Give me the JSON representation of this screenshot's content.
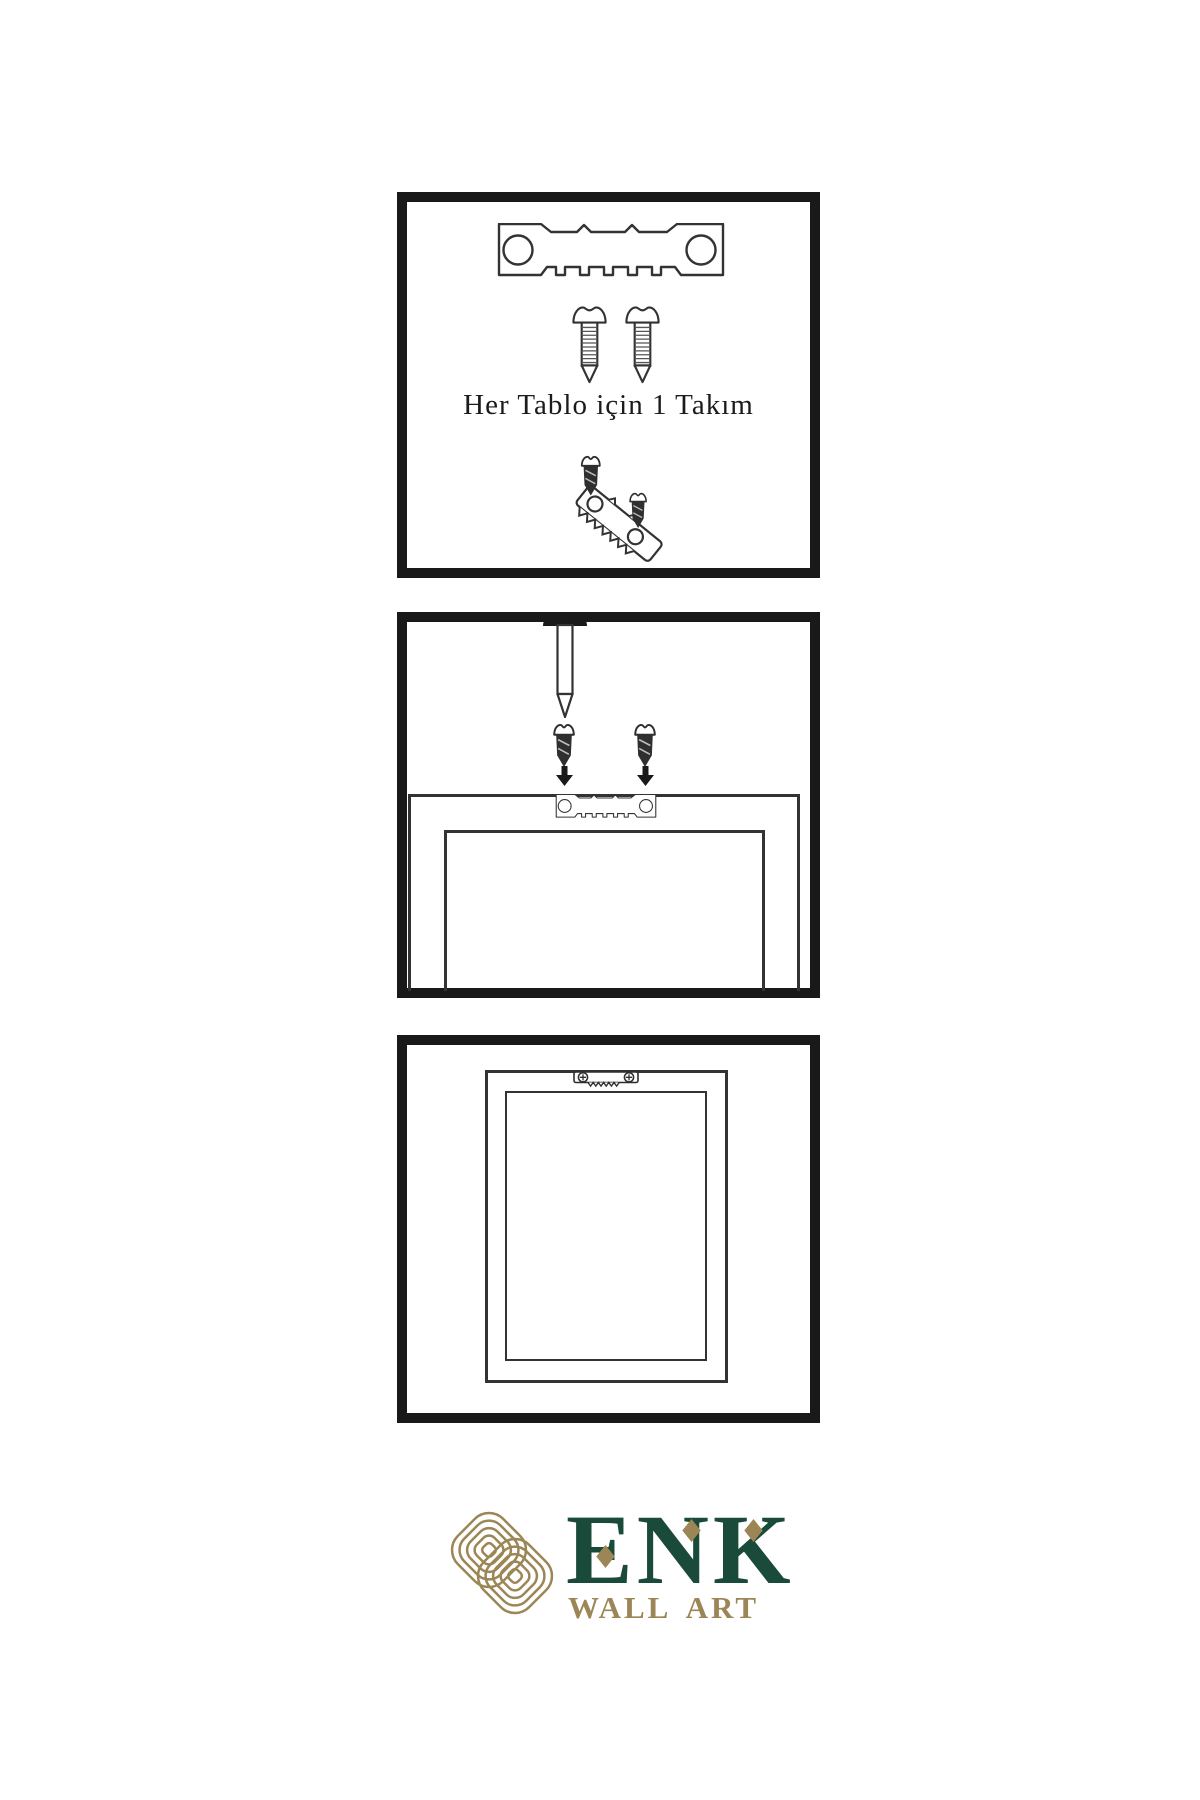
{
  "colors": {
    "background": "#ffffff",
    "ink": "#191919",
    "line": "#333333",
    "screw_dark": "#2f2f2f",
    "logo_gold": "#9c8655",
    "logo_green": "#1a4a3a"
  },
  "panel_kit": {
    "caption": "Her Tablo için 1 Takım"
  },
  "logo": {
    "name": "ENK",
    "subtitle": "WALL ART"
  }
}
